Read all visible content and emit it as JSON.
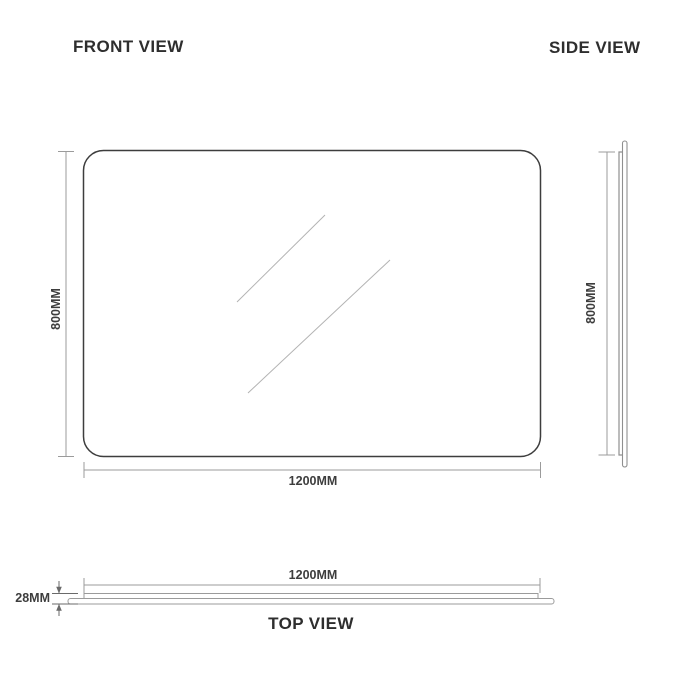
{
  "document": {
    "type": "product-dimension-drawing",
    "subject": "rectangular mirror"
  },
  "colors": {
    "outline": "#3d3d3d",
    "dimension_line": "#9b9b9b",
    "profile_line": "#8f8f8f",
    "glare_line": "#b3b3b3",
    "title_text": "#2e2e2e",
    "dimension_text": "#3d3d3d",
    "background": "#ffffff"
  },
  "front_view": {
    "title": "FRONT VIEW",
    "height_label": "800MM",
    "width_label": "1200MM"
  },
  "side_view": {
    "title": "SIDE VIEW",
    "height_label": "800MM"
  },
  "top_view": {
    "title": "TOP VIEW",
    "width_label": "1200MM",
    "depth_label": "28MM"
  }
}
